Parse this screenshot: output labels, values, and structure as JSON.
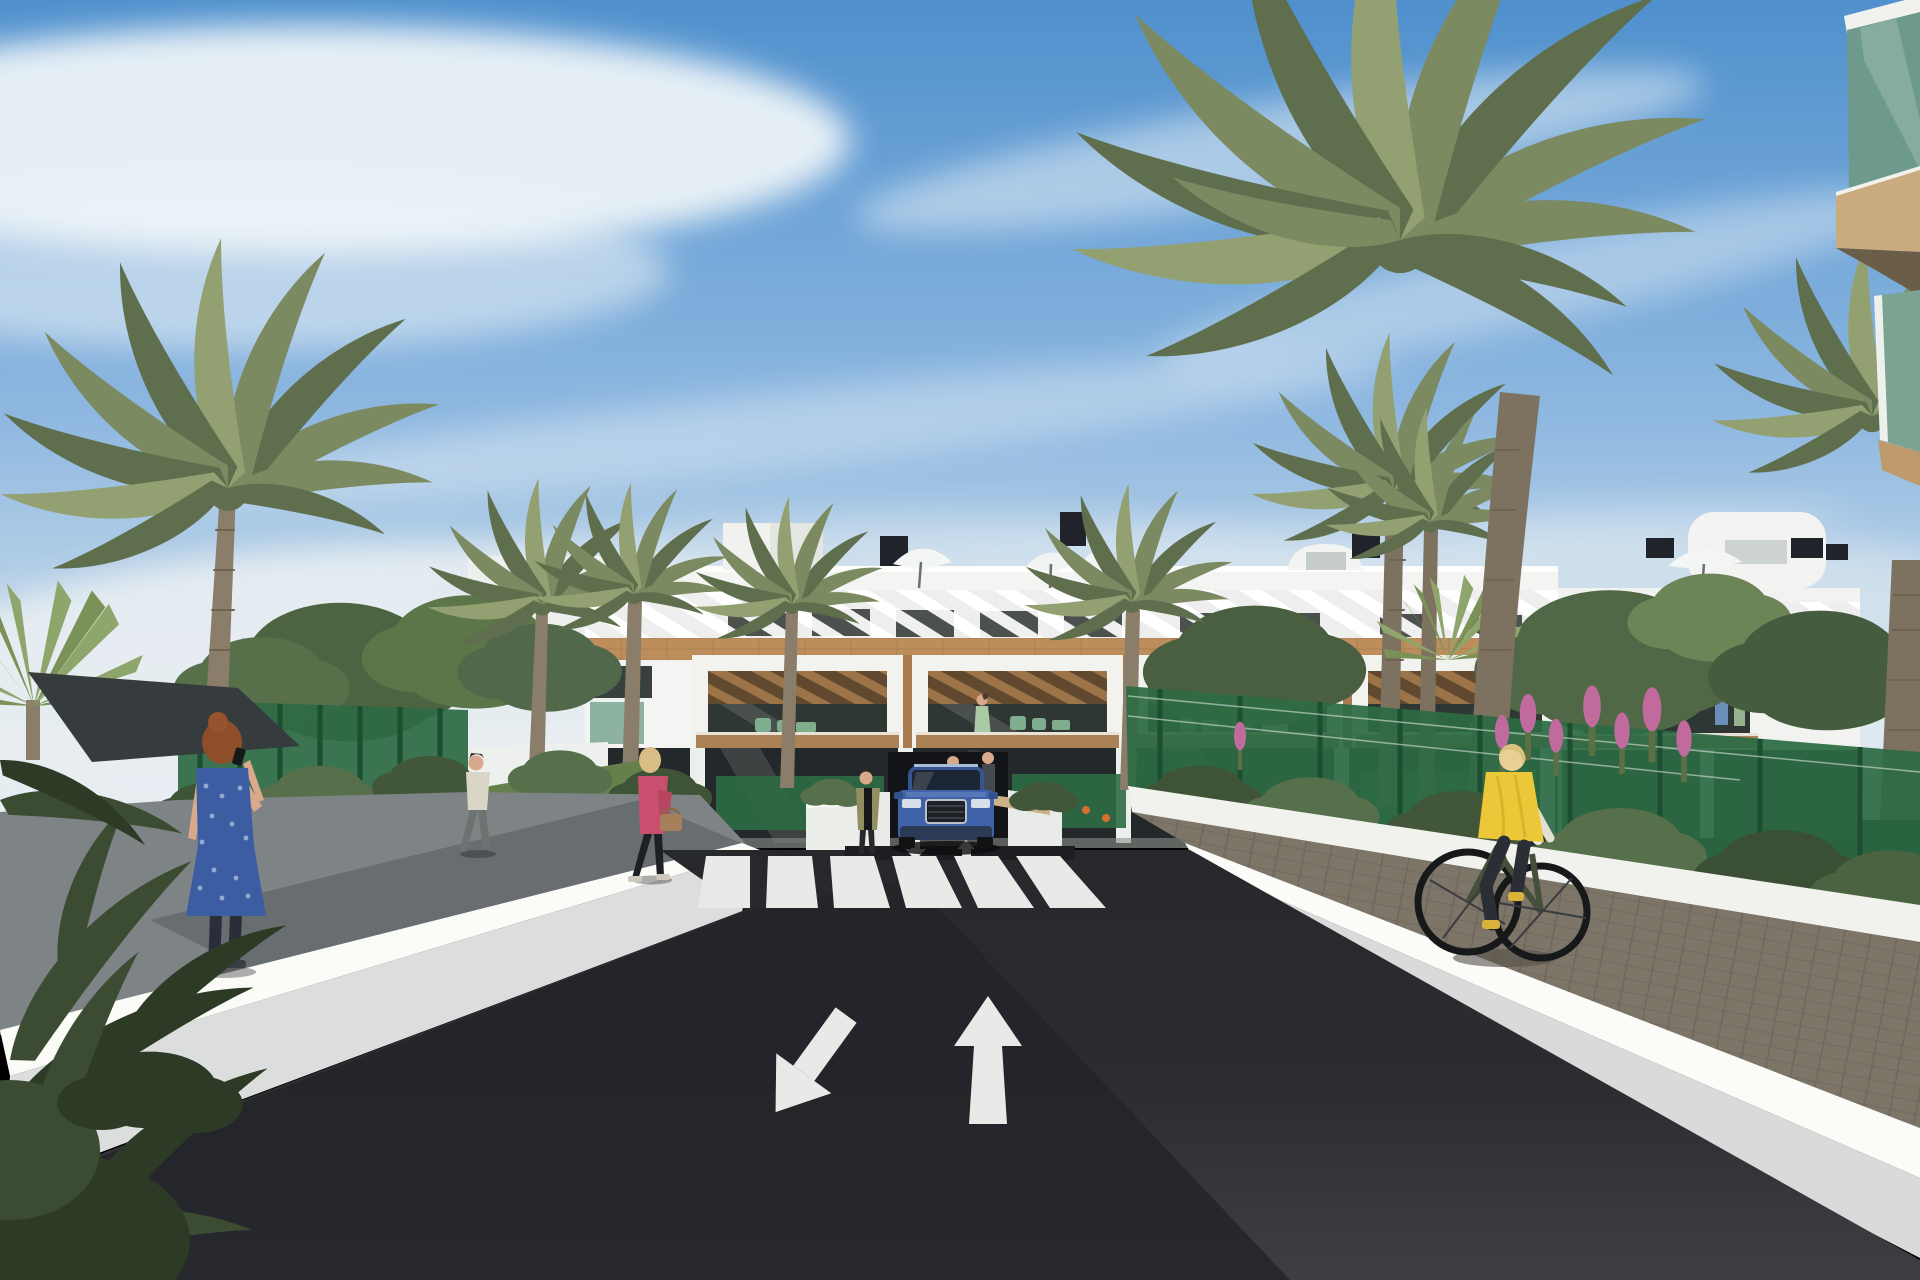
{
  "scene": {
    "type": "architectural-render",
    "setting": "Sunny 3D visualization of a modern white Mediterranean apartment complex with palm gardens",
    "objects": [
      "sky-with-cirrus-clouds",
      "white-apartment-building",
      "rooftop-pergola-slats",
      "rooftop-chimneys",
      "rooftop-parasols",
      "wood-cladding-band",
      "balcony-units-with-pergolas",
      "balcony-residents",
      "underground-garage-entrance",
      "blue-suv",
      "asphalt-driveway",
      "zebra-crossing",
      "lane-direction-arrows",
      "left-retaining-wall",
      "right-retaining-wall",
      "paver-cycle-path",
      "green-mesh-fences",
      "garden-shrubs-and-lawn",
      "orange-flowers",
      "pink-flower-spikes",
      "date-palms",
      "fan-palm",
      "dark-shade-sail",
      "woman-on-phone-blue-dress",
      "woman-walking-pink-jacket",
      "man-walking",
      "woman-standing-by-garage",
      "cyclist-yellow-vest",
      "foreground-corner-balcony"
    ]
  },
  "palette": {
    "sky_top": "#4f90cd",
    "sky_mid": "#8db7e0",
    "sky_low": "#c9dcea",
    "sky_horizon": "#e9f0f4",
    "cloud": "#eef4f8",
    "building_white": "#f4f5f2",
    "wood": "#bd8e5c",
    "wood_dark": "#a87c4e",
    "glass_dark": "#2f3734",
    "fence_green": "#2d6b44",
    "palm_green": "#7c8a62",
    "palm_dark": "#5f6f4e",
    "road_far": "#27282b",
    "road_near": "#3e3f44",
    "road_shadow": "#232429",
    "marking_white": "#e8eae7",
    "wall_white": "#fbfbf8",
    "wall_face": "#dcdedd",
    "path_gray": "#7e8386",
    "paver_brown": "#7d7568",
    "lawn_green": "#66804b",
    "car_blue": "#3f62a8",
    "vest_yellow": "#ecc838",
    "dress_blue": "#3d5da2",
    "jacket_pink": "#c8506e",
    "flower_orange": "#d4702c",
    "flower_pink": "#c06a9e",
    "sail_dark": "#363b3e",
    "garage_dark": "#121417",
    "glass_green": "#6e9a8d",
    "skin": "#d9a98c"
  }
}
